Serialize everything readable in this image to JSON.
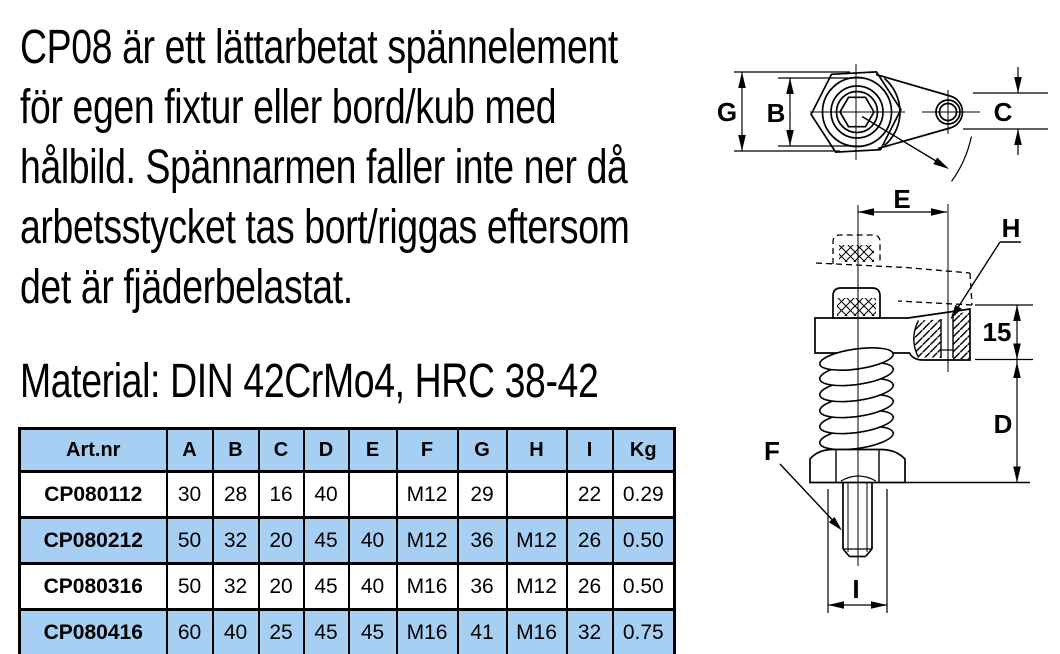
{
  "description": {
    "lines": [
      "CP08 är ett lättarbetat spännelement",
      "för egen fixtur eller bord/kub med",
      "hålbild. Spännarmen faller inte ner då",
      "arbetsstycket tas bort/riggas eftersom",
      "det är fjäderbelastat."
    ],
    "material": "Material: DIN 42CrMo4, HRC 38-42"
  },
  "table": {
    "headers": [
      "Art.nr",
      "A",
      "B",
      "C",
      "D",
      "E",
      "F",
      "G",
      "H",
      "I",
      "Kg"
    ],
    "rows": [
      [
        "CP080112",
        "30",
        "28",
        "16",
        "40",
        "",
        "M12",
        "29",
        "",
        "22",
        "0.29"
      ],
      [
        "CP080212",
        "50",
        "32",
        "20",
        "45",
        "40",
        "M12",
        "36",
        "M12",
        "26",
        "0.50"
      ],
      [
        "CP080316",
        "50",
        "32",
        "20",
        "45",
        "40",
        "M16",
        "36",
        "M12",
        "26",
        "0.50"
      ],
      [
        "CP080416",
        "60",
        "40",
        "25",
        "45",
        "45",
        "M16",
        "41",
        "M16",
        "32",
        "0.75"
      ]
    ]
  },
  "diagram": {
    "top_view": {
      "g": "G",
      "b": "B",
      "c": "C"
    },
    "side_view": {
      "e": "E",
      "h": "H",
      "lift": "15",
      "d": "D",
      "f": "F",
      "i": "I"
    }
  },
  "colors": {
    "table_stripe": "#a6cff3",
    "line": "#000000",
    "background": "#ffffff"
  }
}
